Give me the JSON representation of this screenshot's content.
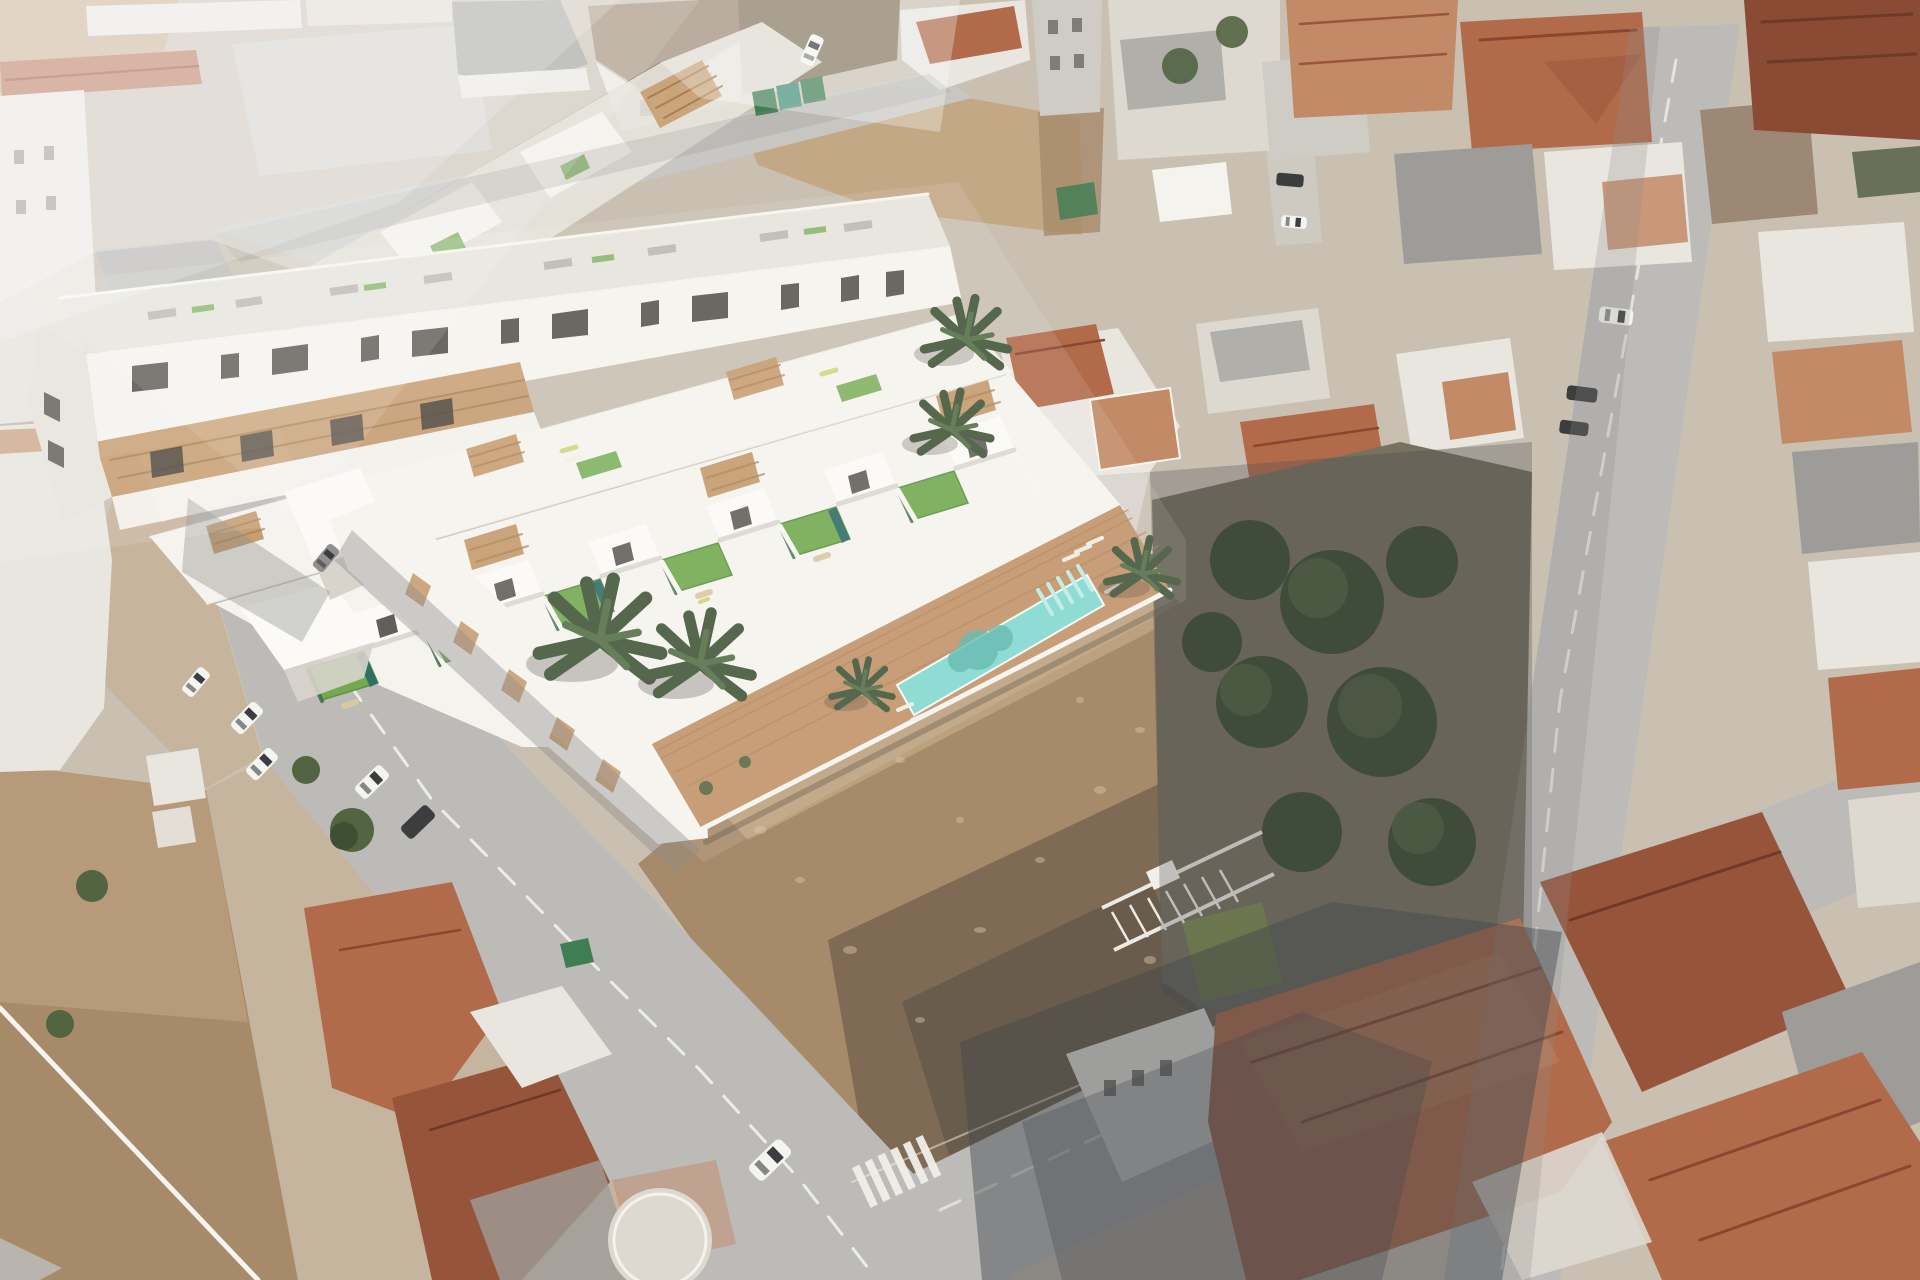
{
  "image": {
    "width": 1920,
    "height": 1280,
    "alt": "Aerial composite image: a 3D architectural render of a new white townhouse development with rooftop artificial-turf terraces, timber pergolas, palm trees, a timber pool deck and a long turquoise communal swimming pool, inserted into an aerial photograph of a dense Spanish coastal town with terracotta roofs, gray streets, parked cars and vacant dirt lots."
  },
  "scene": {
    "kind": "architectural-aerial-visualization",
    "no_visible_text": true,
    "features": [
      "rendered white townhouse development",
      "rear three-storey apartment block with dark window openings",
      "rooftop turf terraces with sun loungers",
      "timber slat pergolas and garage doors",
      "communal turquoise pool with entry steps",
      "timber pool deck with palm trees",
      "existing town with terracotta and gray roofs",
      "vacant scrubland dirt lots",
      "diagonal streets with dashed lane markings",
      "pedestrian zebra crossing",
      "parked cars and vans",
      "green waste containers",
      "white metal truss lying in empty lot",
      "walled gardens with large trees"
    ]
  },
  "palette": {
    "base_ground": "#c9c0b2",
    "street": "#bcbbb8",
    "street_light": "#c8c7c4",
    "street_shadow": "#8e8d8a",
    "dirt_light": "#c3a886",
    "dirt_mid": "#a78a6a",
    "dirt_dark": "#70604e",
    "dirt_shadow": "#564e43",
    "scrub_dark": "#7a6a52",
    "garden_ground": "#77715f",
    "hedge_light": "#7a8a4f",
    "render_white": "#f5f3ee",
    "render_bright": "#fbfaf7",
    "render_white_dim": "#e7e4dd",
    "render_shadow_face": "#d8d4cc",
    "window_dark": "#4c4a44",
    "opening_dark": "#3e3c37",
    "wood_slat": "#c59a6b",
    "deck_wood": "#c2946a",
    "turf_green": "#73aa51",
    "plunge_teal": "#2f6f66",
    "pool_turquoise": "#82d8cf",
    "pool_shadow": "#58b5ac",
    "palm_dark": "#42573a",
    "palm_mid": "#567049",
    "tree_dark": "#3e4f33",
    "tree_mid": "#526442",
    "terracotta": "#b16b4b",
    "terracotta_dark": "#96543a",
    "terracotta_pale": "#c28a66",
    "rust_dark": "#8a4a34",
    "roof_gray": "#9d9c98",
    "roof_brown": "#9c8874",
    "roof_pale": "#cfccc6",
    "building_white": "#e9e6e0",
    "building_cream": "#ded9d0",
    "car_white": "#f4f4f1",
    "car_gray": "#8f8f8d",
    "car_dark": "#3c3d3e",
    "bin_green": "#3f7d52",
    "bin_teal": "#3f8f7a",
    "lounger_white": "#f1efe9",
    "clutter_gray": "#b5b2ab",
    "furniture_beige": "#d8c8a4",
    "shadow_cool": "#43464b",
    "shadow_warm": "#4a4237",
    "haze_white": "#ffffff"
  }
}
